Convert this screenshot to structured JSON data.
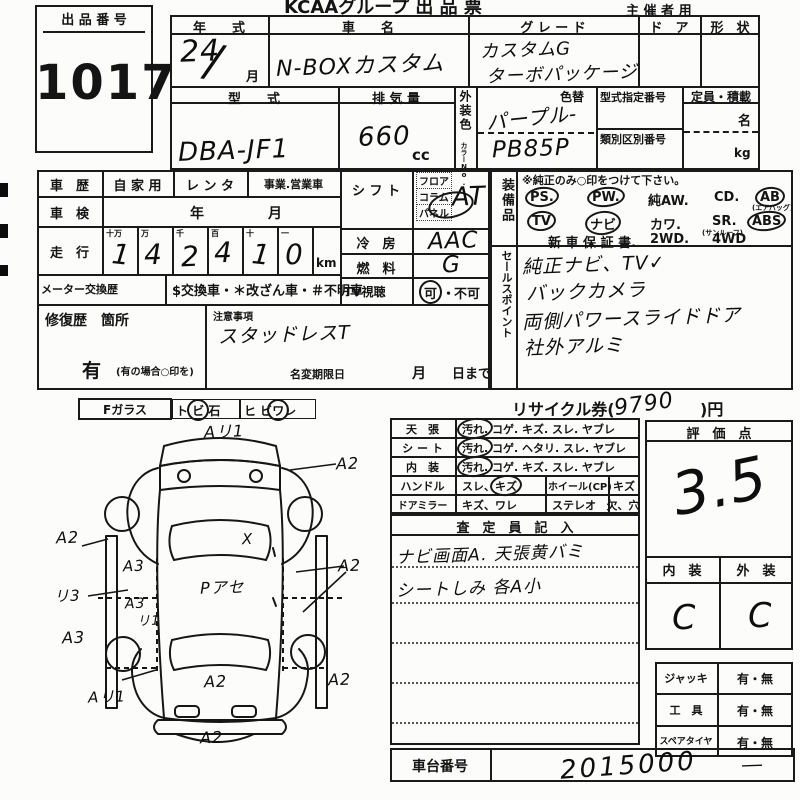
{
  "header": {
    "brand_title": "KCAAグループ 出 品 票",
    "audience": "主 催 者 用"
  },
  "lot": {
    "label": "出 品 番 号",
    "number": "1017"
  },
  "vehicle": {
    "year_label": "年　　式",
    "year_value": "24",
    "year_slash": "/",
    "month_suffix": "月",
    "name_label": "車　　名",
    "name_value": "N-BOXカスタム",
    "grade_label": "グ レ ー ド",
    "grade_line1": "カスタムG",
    "grade_line2": "ターボパッケージ",
    "door_label": "ド　ア",
    "shape_label": "形　状",
    "model_label": "型　　式",
    "model_value": "DBA-JF1",
    "disp_label": "排 気 量",
    "disp_value": "660",
    "disp_unit": "cc",
    "color_label": "外装色",
    "color_no_label": "カラーNo.",
    "color_change_label": "色替",
    "color_value": "パープル-",
    "color_code": "PB85P",
    "type_no_label": "型式指定番号",
    "class_no_label": "類別区別番号",
    "capacity_label": "定員・積載",
    "capacity_unit1": "名",
    "capacity_unit2": "kg"
  },
  "history": {
    "label": "車　歴",
    "opt1": "自 家 用",
    "opt2": "レ ン タ",
    "opt3": "事業.営業車",
    "shaken_label": "車　検",
    "shaken_year": "年",
    "shaken_month": "月",
    "mileage_label": "走　行",
    "digit_heads": [
      "十万",
      "万",
      "千",
      "百",
      "十",
      "一"
    ],
    "digits": [
      "1",
      "4",
      "2",
      "4",
      "1",
      "0"
    ],
    "mileage_unit": "km",
    "meter_label": "メーター交換歴",
    "meter_options": "$交換車・＊改ざん車・＃不明車"
  },
  "shift": {
    "label": "シ フ ト",
    "opt1": "フロア",
    "opt2": "コラム",
    "opt3": "パネル",
    "value": "AT"
  },
  "ac": {
    "label": "冷　房",
    "value": "AAC"
  },
  "fuel": {
    "label": "燃　料",
    "value": "G"
  },
  "tv": {
    "label": "TV視聴",
    "ok": "可",
    "sep": "・",
    "ng": "不可"
  },
  "equipment": {
    "label": "装備品",
    "note": "※純正のみ○印をつけて下さい。",
    "i1": "PS.",
    "i2": "PW.",
    "i3": "純AW.",
    "i4": "CD.",
    "i5": "AB",
    "i5sub": "(エアバッグ)",
    "i6": "TV",
    "i7": "ナビ",
    "i8": "カワ.",
    "i9": "SR.",
    "i9sub": "(サンルーフ)",
    "i10": "ABS",
    "i11": "新 車 保 証 書.",
    "i12": "2WD.",
    "i13": "4WD"
  },
  "sales": {
    "label": "セールスポイント",
    "line1": "純正ナビ、TV✓",
    "line2": "バックカメラ",
    "line3": "両側パワースライドドア",
    "line4": "社外アルミ"
  },
  "repair": {
    "label": "修復歴　箇所",
    "yes": "有",
    "note": "(有の場合○印を)"
  },
  "caution": {
    "label": "注意事項",
    "value": "スタッドレスT",
    "deadline_label": "名変期限日",
    "month": "月",
    "day": "日まで"
  },
  "recycle": {
    "label": "リサイクル券(",
    "amount": "9790",
    "close": ")円"
  },
  "condition": {
    "r1_label": "天　張",
    "r1_circled": "汚れ.",
    "r1_rest": "コゲ. キズ. スレ. ヤブレ",
    "r2_label": "シ ー ト",
    "r2_circled": "汚れ.",
    "r2_rest": "コゲ. ヘタリ. スレ. ヤブレ",
    "r3_label": "内　装",
    "r3_circled": "汚れ.",
    "r3_rest": "コゲ. キズ. スレ. ヤブレ",
    "r4_label": "ハンドル",
    "r4_pre": "スレ、",
    "r4_circled": "キズ",
    "r4_label2": "ホイール(CP)",
    "r4_val2": "キズ",
    "r5_label": "ドアミラー",
    "r5_val": "キズ、ワレ",
    "r5_label2": "ステレオ",
    "r5_val2": "欠、穴"
  },
  "inspector": {
    "title": "査　定　員　記　入",
    "line1": "ナビ画面A. 天張黄バミ",
    "line2": "シートしみ 各A小"
  },
  "score": {
    "title": "評　価　点",
    "value": "3.5",
    "interior_label": "内　装",
    "exterior_label": "外　装",
    "interior_value": "C",
    "exterior_value": "C"
  },
  "accessories": {
    "r1_label": "ジャッキ",
    "r2_label": "工　具",
    "r3_label": "スペアタイヤ",
    "value": "有・無"
  },
  "chassis": {
    "label": "車台番号",
    "value": "2015000",
    "dash": "―"
  },
  "glass": {
    "label": "Fガラス",
    "o1_pre": "ト",
    "o1_circ": "ビ",
    "o1_post": "石",
    "o2_pre": "ヒ ビ",
    "o2_circ": "ワ",
    "o2_post": "レ"
  },
  "diagram": {
    "labels": [
      {
        "t": "Aリ1"
      },
      {
        "t": "A2"
      },
      {
        "t": "A2"
      },
      {
        "t": "A3"
      },
      {
        "t": "リ3"
      },
      {
        "t": "A3"
      },
      {
        "t": "リ1"
      },
      {
        "t": "A3"
      },
      {
        "t": "Pアセ"
      },
      {
        "t": "X"
      },
      {
        "t": "A2"
      },
      {
        "t": "Aリ1"
      },
      {
        "t": "A2"
      },
      {
        "t": "A2"
      },
      {
        "t": "A2"
      }
    ]
  },
  "colors": {
    "ink": "#161616",
    "paper": "#fcfcfa"
  }
}
